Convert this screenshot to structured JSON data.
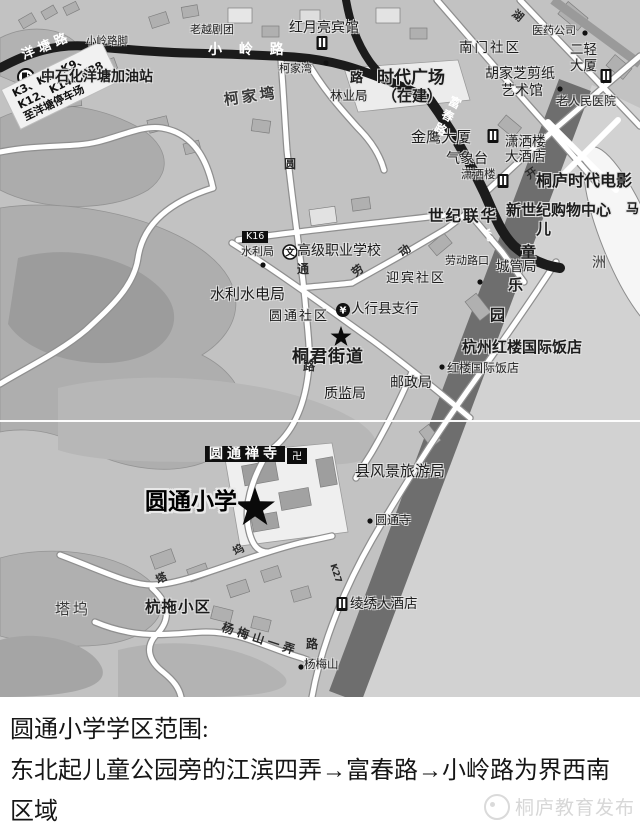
{
  "caption": {
    "line1": "圆通小学学区范围:",
    "line2": "东北起儿童公园旁的江滨四弄→富春路→小岭路为界西南区域",
    "watermark": "桐庐教育发布"
  },
  "map": {
    "bus_note": {
      "line1": "K3、K6、K9、",
      "line2": "K12、K14、K28",
      "line3": "至洋塘停车场"
    },
    "icons": {
      "bank": "¥",
      "school": "文",
      "temple": "卍",
      "star": "★",
      "bus_stop": "●",
      "gas_station": "⛽",
      "hotel": "▯"
    },
    "colors": {
      "map_bg": "#c2c2c2",
      "river": "#d2d2d2",
      "riverbank_band": "#6e6e6e",
      "road_black": "#1b1b1b",
      "road_white": "#ffffff",
      "hill": "#aeaeae",
      "label_dark": "#1c1c1c"
    },
    "labels": [
      {
        "n": "road-label-yangtang-road",
        "t": "洋 塘 路",
        "x": 20,
        "y": 50,
        "fs": 13,
        "r": -22,
        "c": "w b"
      },
      {
        "n": "stop-label-xiaolinglujiao",
        "t": "小岭路脚",
        "x": 86,
        "y": 36,
        "fs": 10.5,
        "c": "st"
      },
      {
        "n": "road-label-xiaoling-road",
        "t": "小 岭 路",
        "x": 208,
        "y": 43,
        "fs": 14,
        "ls": 6,
        "c": "w b"
      },
      {
        "n": "poi-label-laoyue-opera",
        "t": "老越剧团",
        "x": 190,
        "y": 24,
        "fs": 11,
        "c": "st"
      },
      {
        "n": "poi-label-hongyueliang-hotel",
        "t": "红月亮宾馆",
        "x": 289,
        "y": 21,
        "fs": 14
      },
      {
        "n": "stop-label-kejiawan",
        "t": "柯家湾",
        "x": 279,
        "y": 63,
        "fs": 11,
        "c": "st"
      },
      {
        "n": "poi-label-sinopec-gas-station",
        "t": "中石化洋塘加油站",
        "x": 41,
        "y": 70,
        "fs": 14,
        "c": "b"
      },
      {
        "n": "area-label-kejiawan",
        "t": "柯家塆",
        "x": 223,
        "y": 93,
        "fs": 15,
        "ls": 3,
        "r": -8,
        "c": "ar b"
      },
      {
        "n": "road-char-lu-1",
        "t": "路",
        "x": 350,
        "y": 72,
        "fs": 13,
        "c": "b"
      },
      {
        "n": "poi-label-shidai-plaza",
        "t": "时代广场",
        "x": 377,
        "y": 70,
        "fs": 17,
        "c": "b"
      },
      {
        "n": "poi-label-shidai-plaza-2",
        "t": "（在建）",
        "x": 382,
        "y": 89,
        "fs": 15,
        "c": "b"
      },
      {
        "n": "poi-label-forestry-bureau",
        "t": "林业局",
        "x": 330,
        "y": 90,
        "fs": 12.5
      },
      {
        "n": "poi-label-nanmen-community",
        "t": "南门社区",
        "x": 459,
        "y": 42,
        "fs": 13.5,
        "ls": 2
      },
      {
        "n": "poi-label-pharma-company",
        "t": "医药公司",
        "x": 532,
        "y": 25,
        "fs": 11,
        "c": "st"
      },
      {
        "n": "road-char-hu",
        "t": "湖",
        "x": 517,
        "y": 8,
        "fs": 11,
        "r": 40,
        "c": "rd"
      },
      {
        "n": "poi-label-erqing-tower-1",
        "t": "二轻",
        "x": 570,
        "y": 44,
        "fs": 13.5
      },
      {
        "n": "poi-label-erqing-tower-2",
        "t": "大厦",
        "x": 570,
        "y": 60,
        "fs": 13.5
      },
      {
        "n": "poi-label-hujiazhi-papercut-1",
        "t": "胡家芝剪纸",
        "x": 485,
        "y": 67,
        "fs": 14
      },
      {
        "n": "poi-label-hujiazhi-papercut-2",
        "t": "艺术馆",
        "x": 501,
        "y": 84,
        "fs": 14
      },
      {
        "n": "poi-label-old-peoples-hospital",
        "t": "老人民医院",
        "x": 556,
        "y": 95,
        "fs": 12,
        "c": "st"
      },
      {
        "n": "poi-label-jinying-tower",
        "t": "金鹰大厦",
        "x": 411,
        "y": 130,
        "fs": 15
      },
      {
        "n": "poi-label-weather-station",
        "t": "气象台",
        "x": 446,
        "y": 152,
        "fs": 14
      },
      {
        "n": "poi-label-xiaosalou-hotel-1",
        "t": "潇洒楼",
        "x": 505,
        "y": 136,
        "fs": 13.5
      },
      {
        "n": "poi-label-xiaosalou-hotel-2",
        "t": "大酒店",
        "x": 505,
        "y": 151,
        "fs": 13.5
      },
      {
        "n": "stop-label-xiaosalou",
        "t": "潇洒楼",
        "x": 461,
        "y": 169,
        "fs": 11.5,
        "c": "st"
      },
      {
        "n": "road-char-kai",
        "t": "开",
        "x": 524,
        "y": 172,
        "fs": 11,
        "r": -35,
        "c": "rd"
      },
      {
        "n": "poi-label-tonglu-cinema",
        "t": "桐庐时代电影",
        "x": 536,
        "y": 173,
        "fs": 16,
        "c": "b"
      },
      {
        "n": "road-label-fuchun-road",
        "t": "富春路",
        "x": 452,
        "y": 94,
        "fs": 12,
        "ls": 3,
        "r": 28,
        "c": "w b v"
      },
      {
        "n": "poi-label-shiji-lianhua",
        "t": "世纪联华",
        "x": 428,
        "y": 209,
        "fs": 15.5,
        "ls": 2,
        "c": "b"
      },
      {
        "n": "poi-label-new-century-mall",
        "t": "新世纪购物中心",
        "x": 506,
        "y": 203,
        "fs": 15,
        "c": "b"
      },
      {
        "n": "park-char-er",
        "t": "儿",
        "x": 536,
        "y": 222,
        "fs": 15,
        "c": "b"
      },
      {
        "n": "park-char-tong",
        "t": "童",
        "x": 521,
        "y": 245,
        "fs": 15,
        "c": "b"
      },
      {
        "n": "park-char-le",
        "t": "乐",
        "x": 508,
        "y": 278,
        "fs": 15,
        "c": "b"
      },
      {
        "n": "park-char-yuan",
        "t": "园",
        "x": 490,
        "y": 308,
        "fs": 15,
        "c": "b"
      },
      {
        "n": "edge-char-ma",
        "t": "马",
        "x": 626,
        "y": 203,
        "fs": 13,
        "c": "b"
      },
      {
        "n": "area-label-zhou",
        "t": "洲",
        "x": 592,
        "y": 256,
        "fs": 14,
        "c": "ar"
      },
      {
        "n": "bus-route-box-k16",
        "t": "K16",
        "x": 242,
        "y": 231,
        "fs": 9.5,
        "c": "bx"
      },
      {
        "n": "stop-label-shuiliju",
        "t": "水利局",
        "x": 241,
        "y": 246,
        "fs": 11,
        "c": "st"
      },
      {
        "n": "poi-label-vocational-school",
        "t": "高级职业学校",
        "x": 297,
        "y": 244,
        "fs": 14
      },
      {
        "n": "poi-label-yingbin-community",
        "t": "迎宾社区",
        "x": 386,
        "y": 272,
        "fs": 13,
        "ls": 2
      },
      {
        "n": "stop-label-laodonglukou",
        "t": "劳动路口",
        "x": 445,
        "y": 255,
        "fs": 11,
        "c": "st"
      },
      {
        "n": "road-char-dong",
        "t": "动",
        "x": 397,
        "y": 250,
        "fs": 11.5,
        "r": -38,
        "c": "rd"
      },
      {
        "n": "road-char-lao",
        "t": "劳",
        "x": 350,
        "y": 270,
        "fs": 11.5,
        "r": -38,
        "c": "rd"
      },
      {
        "n": "poi-label-chengguanju",
        "t": "城管局",
        "x": 496,
        "y": 261,
        "fs": 13.5
      },
      {
        "n": "poi-label-water-hydro-bureau",
        "t": "水利水电局",
        "x": 210,
        "y": 287,
        "fs": 15
      },
      {
        "n": "poi-label-yuantong-community",
        "t": "圆通社区",
        "x": 269,
        "y": 310,
        "fs": 13,
        "ls": 2
      },
      {
        "n": "poi-label-bank-county-branch",
        "t": "人行县支行",
        "x": 351,
        "y": 303,
        "fs": 13.5
      },
      {
        "n": "poi-label-tongjun-street",
        "t": "桐君街道",
        "x": 292,
        "y": 349,
        "fs": 17,
        "ls": 1,
        "c": "b"
      },
      {
        "n": "road-char-yuan",
        "t": "圆",
        "x": 284,
        "y": 158,
        "fs": 12,
        "c": "rd"
      },
      {
        "n": "road-char-tong",
        "t": "通",
        "x": 297,
        "y": 263,
        "fs": 12,
        "c": "rd"
      },
      {
        "n": "road-char-lu-2",
        "t": "路",
        "x": 303,
        "y": 360,
        "fs": 12,
        "c": "rd"
      },
      {
        "n": "poi-label-zhijianju",
        "t": "质监局",
        "x": 324,
        "y": 387,
        "fs": 14
      },
      {
        "n": "poi-label-youzhengju",
        "t": "邮政局",
        "x": 390,
        "y": 376,
        "fs": 14
      },
      {
        "n": "poi-label-honglou-hotel",
        "t": "杭州红楼国际饭店",
        "x": 462,
        "y": 340,
        "fs": 15,
        "c": "b"
      },
      {
        "n": "stop-label-honglou-hotel",
        "t": "红楼国际饭店",
        "x": 447,
        "y": 362,
        "fs": 12,
        "c": "st"
      },
      {
        "n": "poi-label-yuantong-temple-box",
        "t": "圆通禅寺",
        "x": 205,
        "y": 446,
        "fs": 14,
        "ls": 4,
        "c": "bx b"
      },
      {
        "n": "poi-label-yuantong-school",
        "t": "圆通小学",
        "x": 145,
        "y": 491,
        "fs": 23,
        "c": "ttl"
      },
      {
        "n": "poi-label-scenic-tourism-bureau",
        "t": "县风景旅游局",
        "x": 355,
        "y": 464,
        "fs": 15
      },
      {
        "n": "stop-label-yuantongsi",
        "t": "圆通寺",
        "x": 375,
        "y": 514,
        "fs": 12,
        "c": "st"
      },
      {
        "n": "area-label-tawu",
        "t": "塔坞",
        "x": 55,
        "y": 602,
        "fs": 15,
        "ls": 3,
        "c": "ar"
      },
      {
        "n": "poi-label-hangtuo-estate",
        "t": "杭拖小区",
        "x": 145,
        "y": 600,
        "fs": 15.5,
        "ls": 1,
        "c": "b"
      },
      {
        "n": "road-label-yangmeishan-lane",
        "t": "杨梅山一弄",
        "x": 224,
        "y": 621,
        "fs": 12,
        "ls": 4,
        "r": 18,
        "c": "rd"
      },
      {
        "n": "road-char-ta",
        "t": "塔",
        "x": 154,
        "y": 576,
        "fs": 11,
        "r": -28,
        "c": "rd"
      },
      {
        "n": "road-char-wu",
        "t": "坞",
        "x": 231,
        "y": 548,
        "fs": 11,
        "r": -30,
        "c": "rd"
      },
      {
        "n": "road-char-lu-3",
        "t": "路",
        "x": 306,
        "y": 638,
        "fs": 12,
        "c": "rd"
      },
      {
        "n": "poi-label-lingxiu-hotel",
        "t": "绫绣大酒店",
        "x": 350,
        "y": 598,
        "fs": 13.5
      },
      {
        "n": "stop-label-yangmeishan",
        "t": "杨梅山",
        "x": 304,
        "y": 659,
        "fs": 11.5,
        "c": "st"
      },
      {
        "n": "bus-route-k27",
        "t": "K27",
        "x": 336,
        "y": 563,
        "fs": 9,
        "r": 72,
        "c": "rd"
      },
      {
        "n": "bus-route-k6",
        "t": "K6",
        "x": 489,
        "y": 228,
        "fs": 9,
        "r": 70,
        "c": "w b"
      }
    ]
  }
}
